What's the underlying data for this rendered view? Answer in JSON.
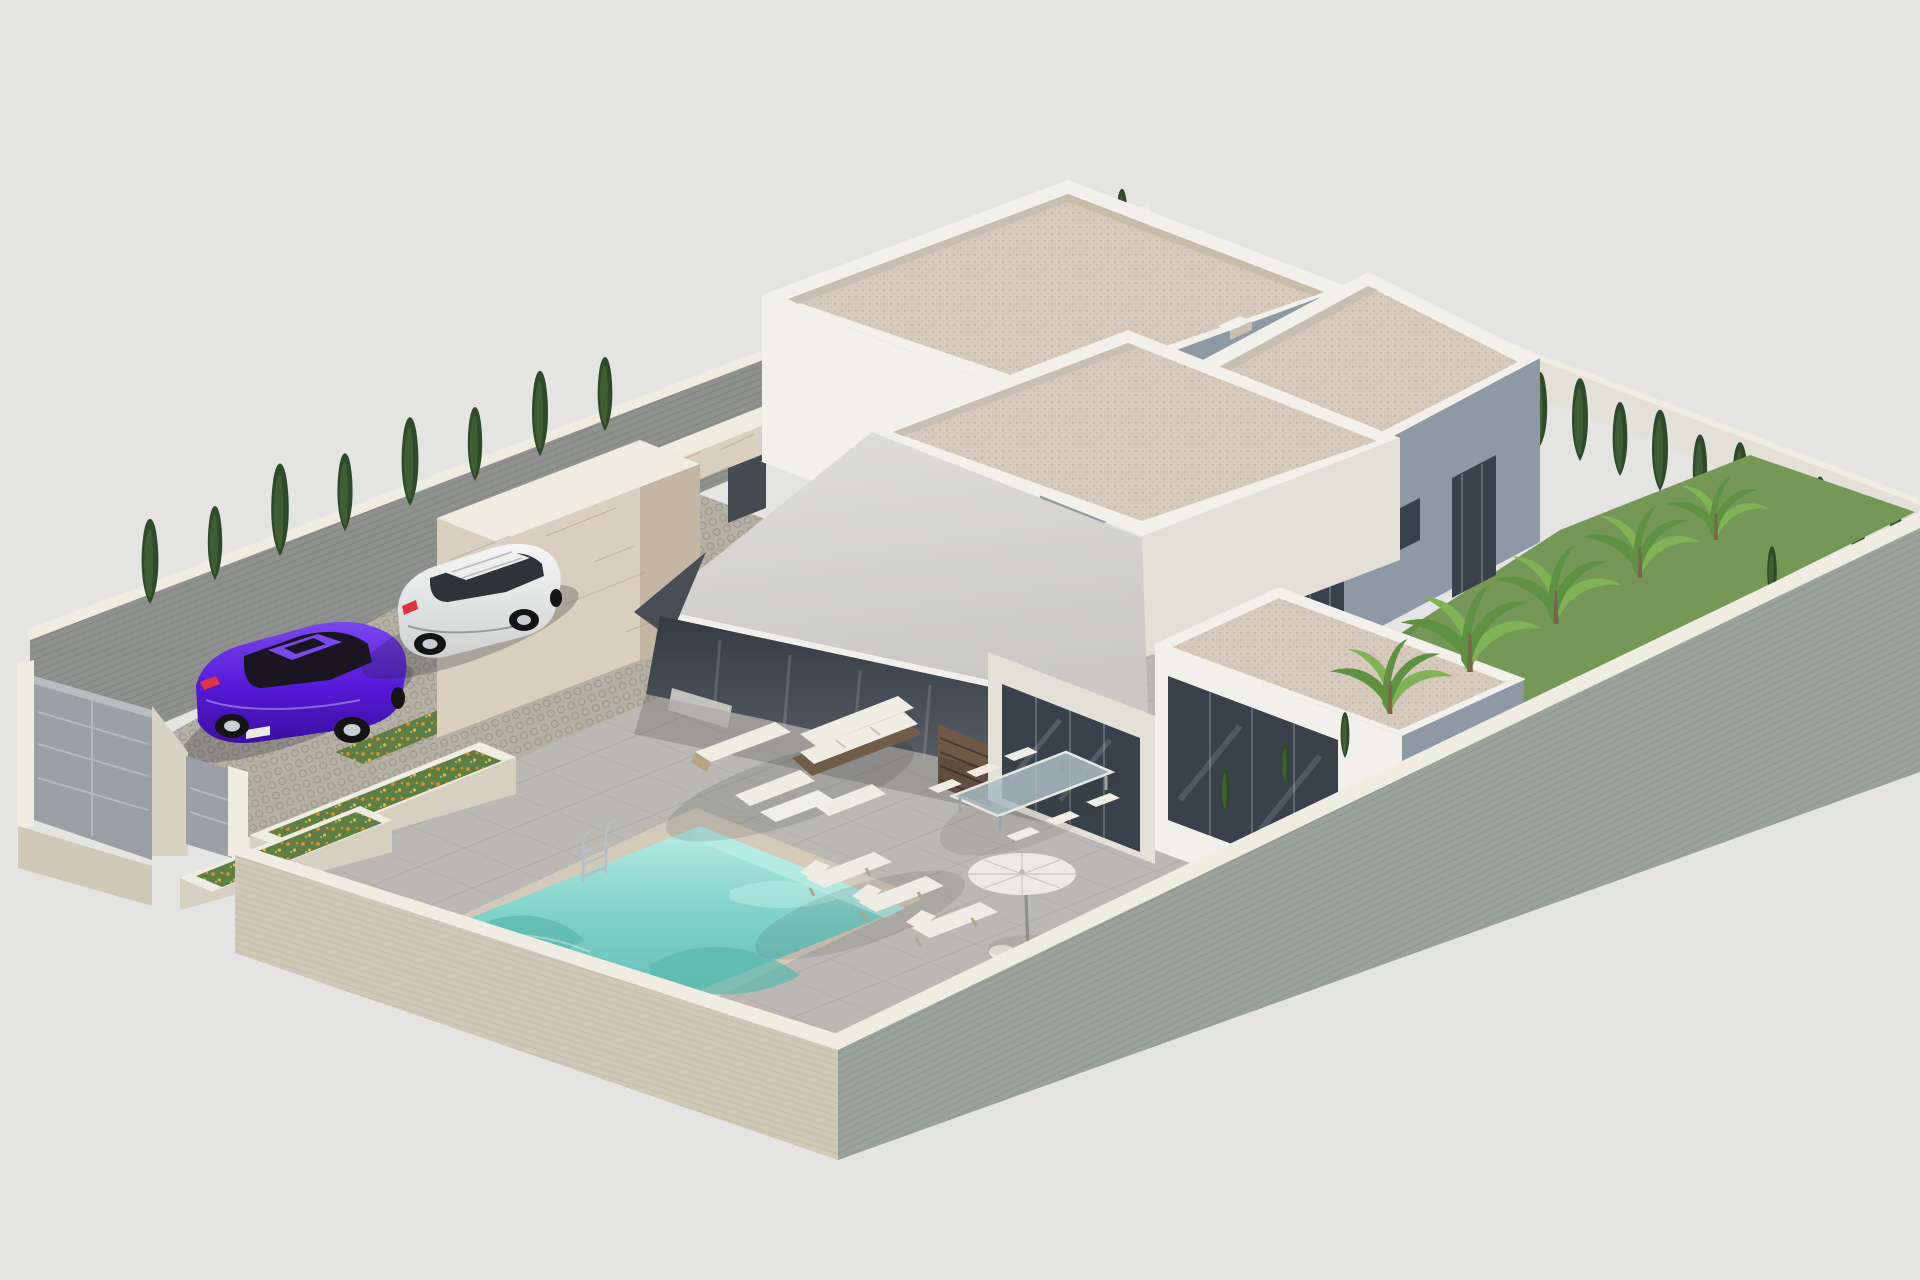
{
  "meta": {
    "title": "Isometric 3D architectural rendering of a modern single-storey villa plot with parking, swimming pool and garden",
    "render_style": "axonometric exterior visualization, flat light gray backdrop",
    "canvas": {
      "width_px": 1920,
      "height_px": 1280
    }
  },
  "palette": {
    "background": "#e4e5e3",
    "building_white_lit": "#f2f0ea",
    "building_white_soft": "#e3e0d8",
    "building_shaded": "#8e99a4",
    "parapet_shadow": "#c6bfb2",
    "roof_gravel": "#d5cabb",
    "roof_gravel_dark": "#c8bcab",
    "canopy_top": "#d7d6d2",
    "canopy_edge": "#f0efeb",
    "canopy_dark": "#494e54",
    "recess_dark": "#434a52",
    "glass_dark": "#39424b",
    "glass_light": "#8a949e",
    "wood_slats": "#6e5946",
    "stone_clad": "#d9cfbf",
    "stone_clad_shade": "#c3b6a2",
    "stone_joint": "#ab9d88",
    "wall_beige": "#d8d2c2",
    "wall_beige_face": "#cfc8b6",
    "wall_cap": "#efece2",
    "wall_gray_green": "#9aa39a",
    "wall_gray_inner": "#8e918d",
    "driveway_cobble": "#b5b0a4",
    "terrace_paving": "#b9b8b2",
    "pool_water": "#7fd2c8",
    "pool_water_deep": "#5cb9ae",
    "pool_ripple_light": "#b8ece4",
    "pool_coping": "#d3caba",
    "grass": "#759857",
    "grass_dark": "#5d7f45",
    "cypress_dark": "#2f4a2b",
    "cypress_light": "#4c6f3b",
    "banana_green": "#5e9142",
    "banana_light": "#7fb355",
    "flower_orange": "#d98f2b",
    "flower_yellow": "#e3b83e",
    "planter_stone": "#d6d0c0",
    "car_purple": "#5519d6",
    "car_purple_dark": "#3c0fa0",
    "car_purple_light": "#7a47ee",
    "car_glass": "#191622",
    "car_white": "#eeeeee",
    "car_white_shade": "#d2d4d4",
    "wheel_dark": "#141414",
    "wheel_rim": "#c9ced4",
    "taillight_red": "#e03540",
    "gate_gray": "#9aa0a3",
    "gate_light": "#b9bdbf",
    "chrome": "#b9bec3",
    "umbrella_white": "#eceae4",
    "cushion_white": "#efece3",
    "lounger_frame": "#b5a584",
    "sofa_wicker": "#6f5d49",
    "table_glass": "#a9bcc2",
    "shadow": "rgba(30,33,40,0.25)"
  },
  "scene": {
    "objects": [
      {
        "name": "backdrop",
        "label": "plain light gray studio backdrop"
      },
      {
        "name": "perimeter-wall-back-left",
        "label": "gray block wall along rear-left boundary"
      },
      {
        "name": "perimeter-wall-back-right",
        "label": "light wall along rear-right boundary"
      },
      {
        "name": "perimeter-wall-front-left",
        "label": "beige brick wall along street side with entrance gates"
      },
      {
        "name": "perimeter-wall-front-right",
        "label": "gray-green brick wall along front-right boundary"
      },
      {
        "name": "vehicle-gate",
        "label": "gray sliding driveway gate"
      },
      {
        "name": "pedestrian-gate",
        "label": "gray pedestrian gate"
      },
      {
        "name": "driveway",
        "label": "cobblestone parking court with two bays"
      },
      {
        "name": "purple-sedan",
        "label": "violet sedan parked in left bay"
      },
      {
        "name": "white-suv",
        "label": "white SUV parked in right bay"
      },
      {
        "name": "flower-beds",
        "label": "strips of orange and yellow flowers between parking bays"
      },
      {
        "name": "stone-planters",
        "label": "raised stone planters with flowers beside pool deck"
      },
      {
        "name": "stone-feature-wall",
        "label": "travertine stone clad entrance wall"
      },
      {
        "name": "building-back-left",
        "label": "tall white flat-roof volume with gravel roof"
      },
      {
        "name": "building-back-right",
        "label": "white volume with shaded facade and window openings"
      },
      {
        "name": "building-main",
        "label": "main living volume with covered terrace"
      },
      {
        "name": "canopy-roof",
        "label": "large tilted gray canopy over terrace"
      },
      {
        "name": "terrace",
        "label": "gray paved pool terrace"
      },
      {
        "name": "swimming-pool",
        "label": "turquoise rectangular pool with chrome ladder"
      },
      {
        "name": "outdoor-sofa-set",
        "label": "wicker sofa with white cushions and ottomans"
      },
      {
        "name": "sun-loungers",
        "label": "three sun loungers beside the pool"
      },
      {
        "name": "parasol",
        "label": "white garden parasol"
      },
      {
        "name": "dining-set",
        "label": "glass dining table with white chairs"
      },
      {
        "name": "garden-right",
        "label": "lawn with banana plants and cypress hedge"
      },
      {
        "name": "cypress-trees",
        "label": "rows of dark green cypress trees along boundary walls"
      }
    ]
  }
}
